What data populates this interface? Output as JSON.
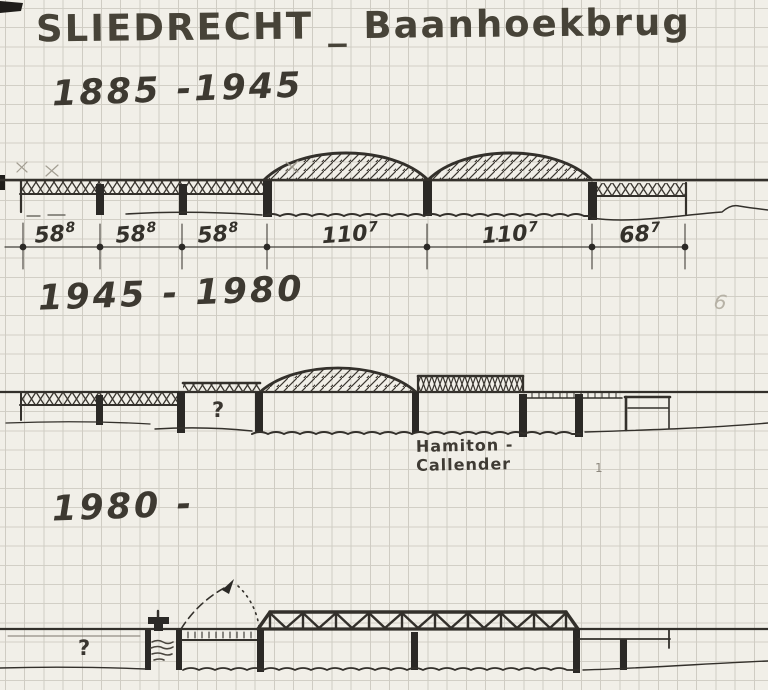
{
  "title": "SLIEDRECHT _ Baanhoekbrug",
  "sections": {
    "first": {
      "period": "1885 -1945",
      "spans": [
        {
          "value": "58",
          "sup": "8"
        },
        {
          "value": "58",
          "sup": "8"
        },
        {
          "value": "58",
          "sup": "8"
        },
        {
          "value": "110",
          "sup": "7"
        },
        {
          "value": "110",
          "sup": "7"
        },
        {
          "value": "68",
          "sup": "7"
        }
      ]
    },
    "second": {
      "period": "1945 - 1980",
      "question_mark": "?",
      "note_line1": "Hamiton -",
      "note_line2": "Callender"
    },
    "third": {
      "period": "1980 -",
      "question_mark": "?"
    }
  },
  "stray_marks": {
    "margin_numeral": "6",
    "small_tick": "1"
  },
  "colors": {
    "paper": "#f1efe8",
    "grid": "#cfccc3",
    "ink": "#33302b",
    "pencil": "#8d887e"
  }
}
